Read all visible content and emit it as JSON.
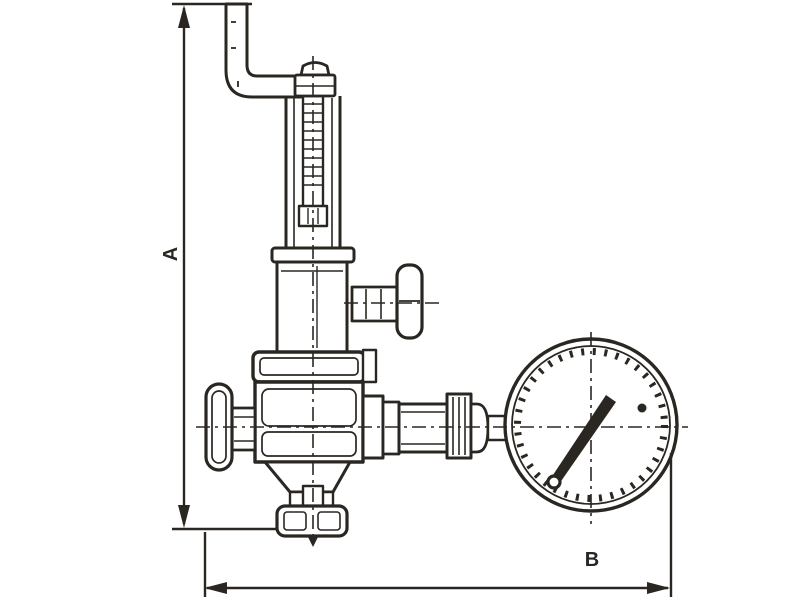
{
  "figure": {
    "type": "technical-dimension-drawing",
    "subject": "pressure reducing valve with pressure gauge",
    "dimensions": {
      "a_label": "A",
      "b_label": "B"
    },
    "colors": {
      "ink": "#2a2722",
      "background": "#ffffff"
    }
  }
}
